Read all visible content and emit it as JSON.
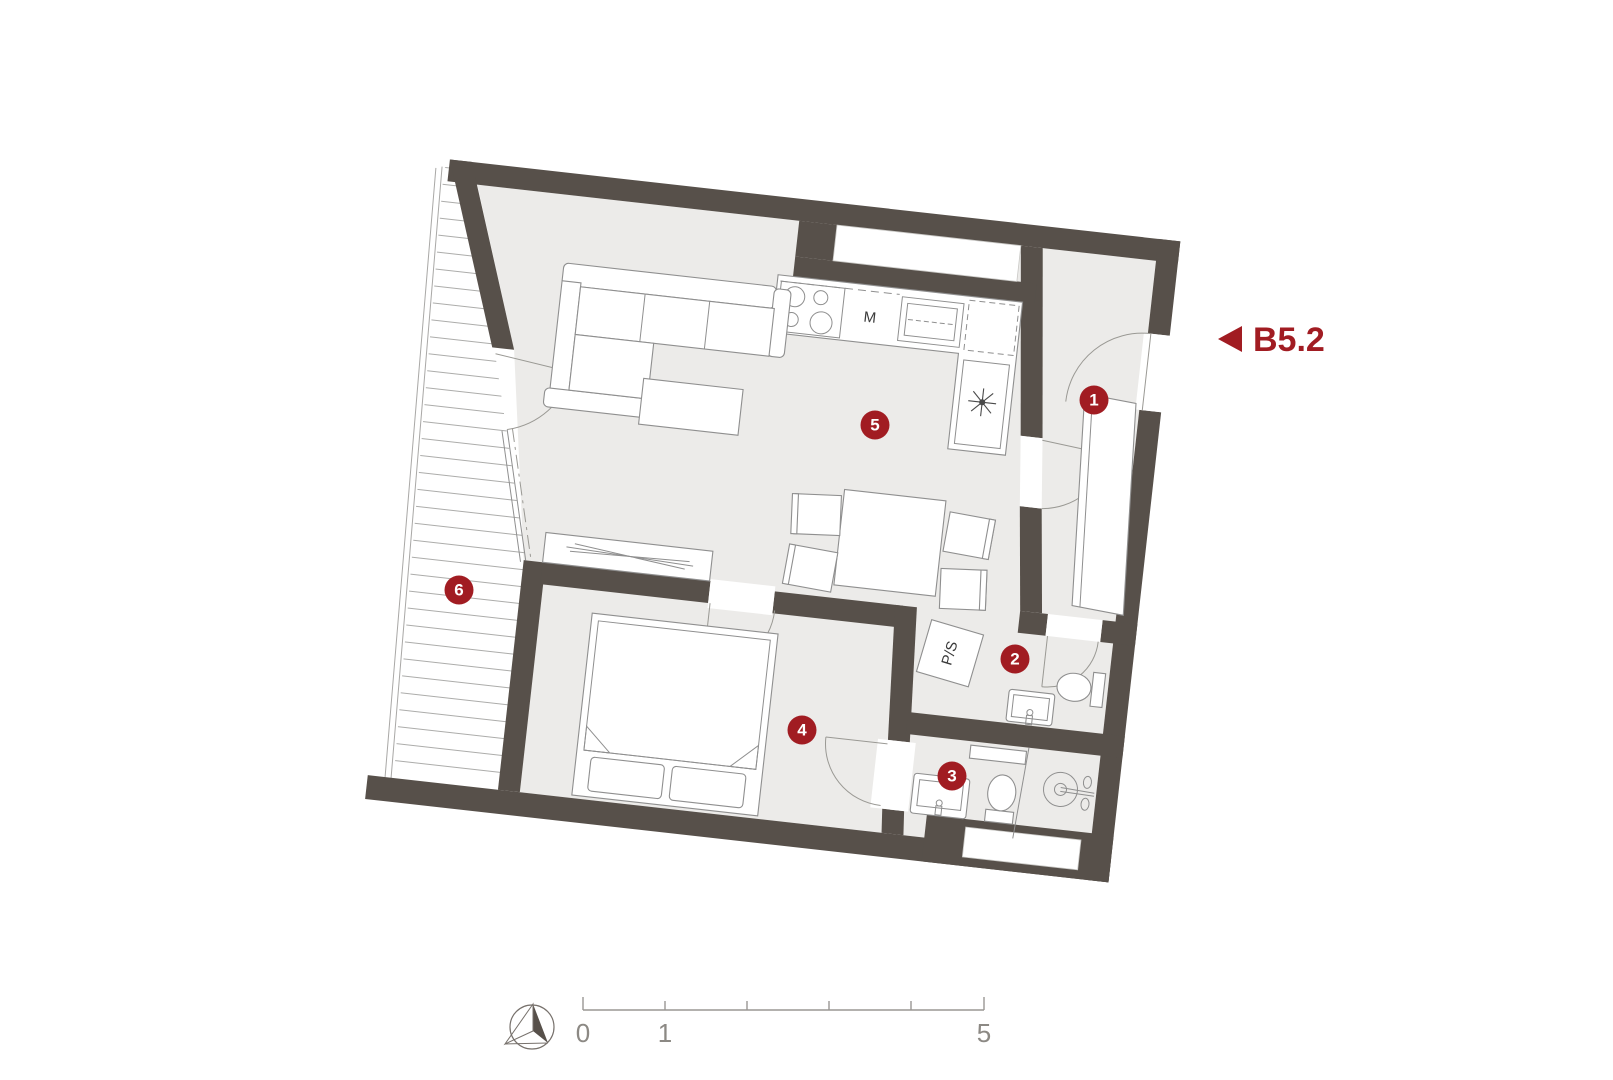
{
  "plan": {
    "unit_label": "B5.2",
    "rooms": [
      {
        "id": 1,
        "number": "1"
      },
      {
        "id": 2,
        "number": "2"
      },
      {
        "id": 3,
        "number": "3"
      },
      {
        "id": 4,
        "number": "4"
      },
      {
        "id": 5,
        "number": "5"
      },
      {
        "id": 6,
        "number": "6"
      }
    ],
    "labels": {
      "microwave": "M",
      "washer_dryer": "P/S"
    },
    "icons": {
      "fridge": "asterisk-icon",
      "entrance": "left-triangle-icon",
      "north": "north-arrow-icon"
    },
    "colors": {
      "wall": "#57504A",
      "floor": "#ECEBE9",
      "accent_red": "#A11C22",
      "furniture_line": "#8F8F8F"
    }
  },
  "scale_bar": {
    "tick_labels": [
      "0",
      "1",
      "5"
    ]
  }
}
